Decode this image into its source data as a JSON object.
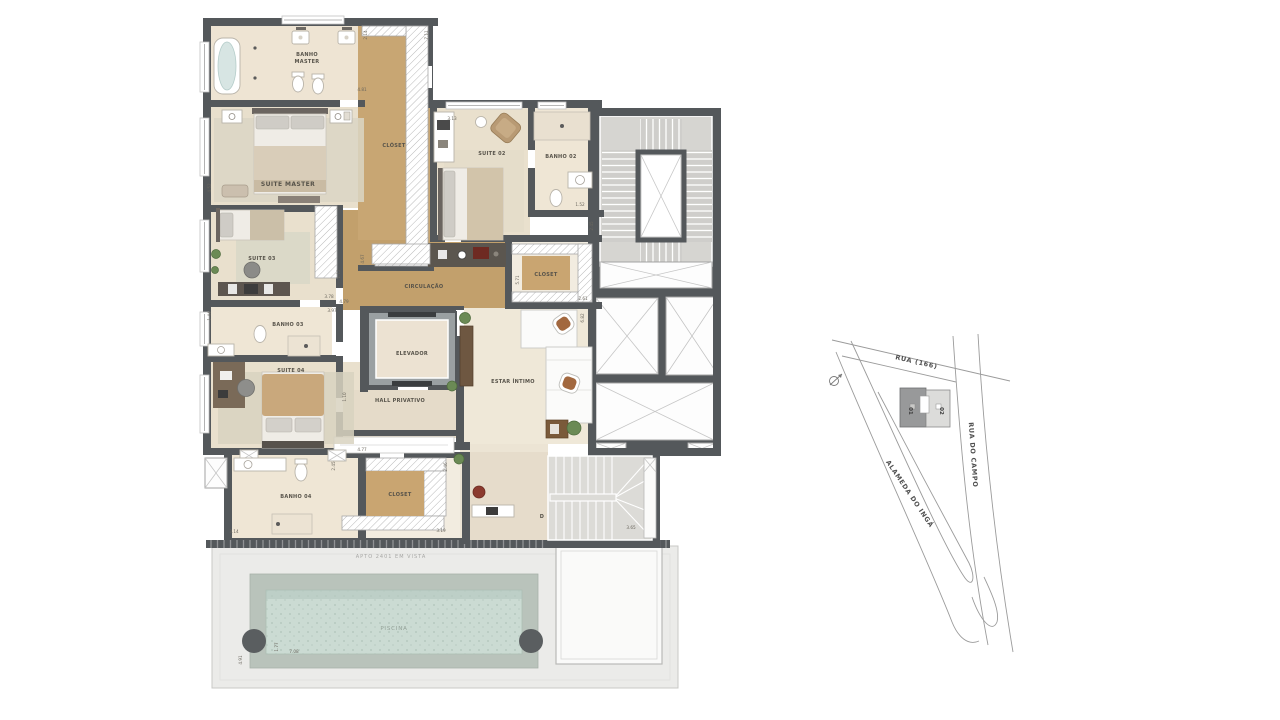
{
  "plan": {
    "rooms": {
      "banho_master_line1": "BANHO",
      "banho_master_line2": "MASTER",
      "suite_master": "SUITE MASTER",
      "closet_master": "CLÓSET",
      "suite_02": "SUITE 02",
      "banho_02": "BANHO 02",
      "suite_03": "SUITE 03",
      "circulacao": "CIRCULAÇÃO",
      "closet_02": "CLOSET",
      "banho_03": "BANHO 03",
      "elevador": "ELEVADOR",
      "hall_privativo": "HALL PRIVATIVO",
      "estar_intimo": "ESTAR ÍNTIMO",
      "suite_04": "SUITE 04",
      "banho_04": "BANHO 04",
      "closet_04": "CLOSET",
      "piscina": "PISCINA"
    },
    "annotations": {
      "apto_note": "APTO 2401 EM VISTA",
      "stair_direction": "D"
    },
    "dimensions": {
      "d_2_14": "2.14",
      "d_7_11": "7.11",
      "d_4_81": "4.81",
      "d_4_52": "4.52",
      "d_3_13": "3.13",
      "d_1_52": "1.52",
      "d_2_45": "2.45",
      "d_2_61": "2.61",
      "d_3_78": "3.78",
      "d_3_97": "3.97",
      "d_1_44": "1.44",
      "d_4_67": "4.67",
      "d_1_12": "1.12",
      "d_4_79": "4.79",
      "d_5_71": "5.71",
      "d_6_82": "6.82",
      "d_1_10": "1.10",
      "d_4_77": "4.77",
      "d_2_45b": "2.45",
      "d_2_46": "2.46",
      "d_3_14": "3.14",
      "d_3_19": "3.19",
      "d_3_65": "3.65",
      "d_4_91": "4.91",
      "d_1_77": "1.77",
      "d_7_08": "7.08"
    }
  },
  "map": {
    "street_top": "RUA (166)",
    "street_right": "RUA DO CAMPO",
    "street_left": "ALAMEDA DO INGÁ",
    "tower_01": "01",
    "tower_02": "02"
  },
  "colors": {
    "wall": "#54585b",
    "wood": "#c8a673",
    "floor_beige": "#ece2d1",
    "concrete": "#d8d7d3",
    "pool_water": "#cbdbd3"
  }
}
